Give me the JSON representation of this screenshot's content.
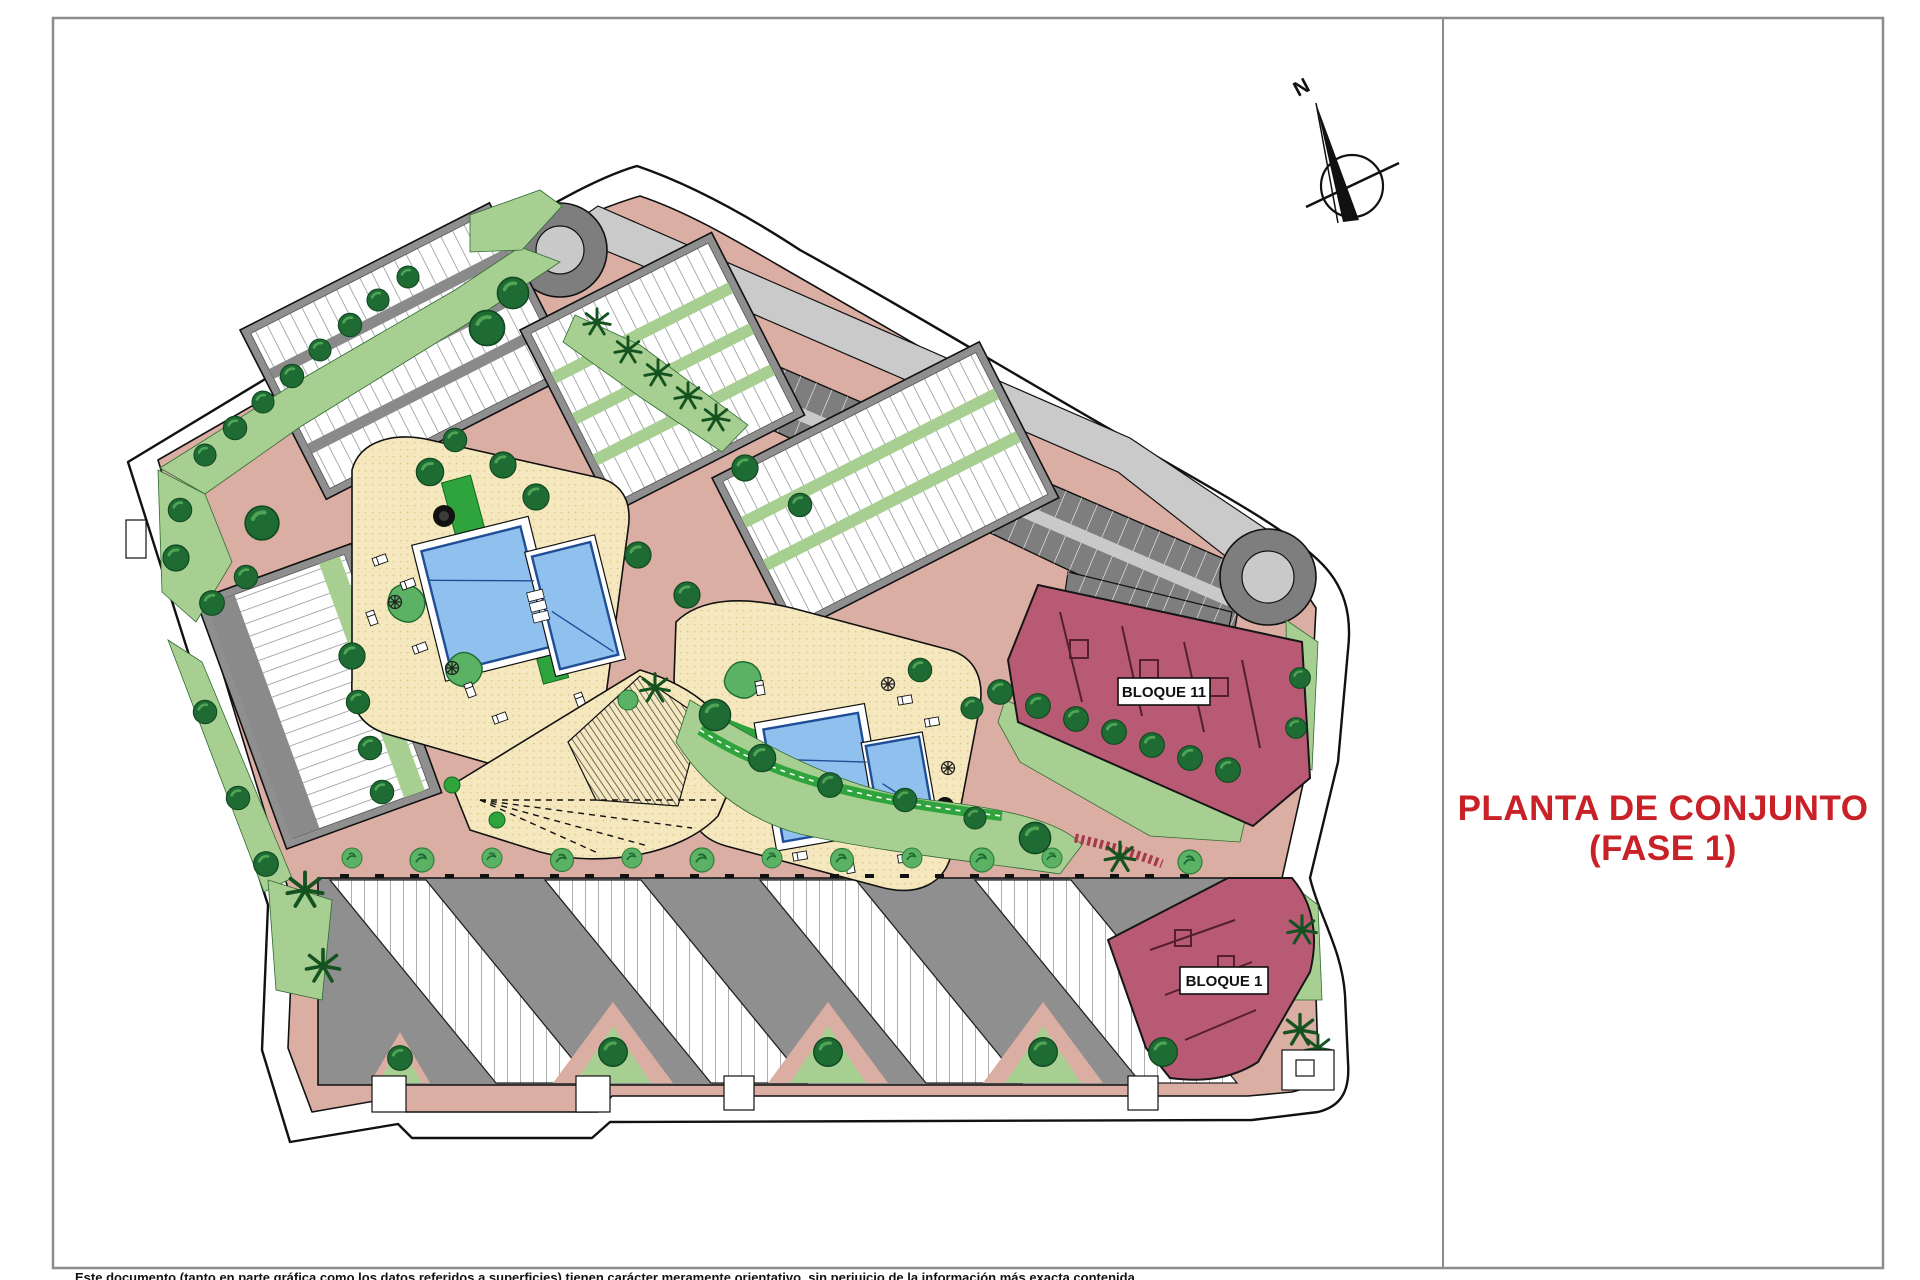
{
  "title": {
    "line1": "PLANTA DE CONJUNTO",
    "line2": "(FASE 1)",
    "color": "#C92128"
  },
  "compass": {
    "north_label": "N"
  },
  "blocks": {
    "bloque11_label": "BLOQUE 11",
    "bloque1_label": "BLOQUE 1",
    "highlight_color": "#B85A73"
  },
  "disclaimer": "Este documento (tanto en parte gráfica como los datos referidos a superficies) tienen carácter meramente orientativo, sin perjuicio de la información más exacta contenida",
  "palette": {
    "frame_gray": "#8C8C8C",
    "path_pink": "#DBAEA3",
    "lawn_green": "#A8CF92",
    "walk_green": "#2FA33C",
    "tree_green": "#1E6B33",
    "amenity_cream": "#F6E8BE",
    "pool_blue": "#8FC0EE",
    "parking_dark": "#7E7E7E",
    "road_light": "#CACACB",
    "building_white": "#FFFFFF",
    "building_gray": "#8F8F8F"
  }
}
